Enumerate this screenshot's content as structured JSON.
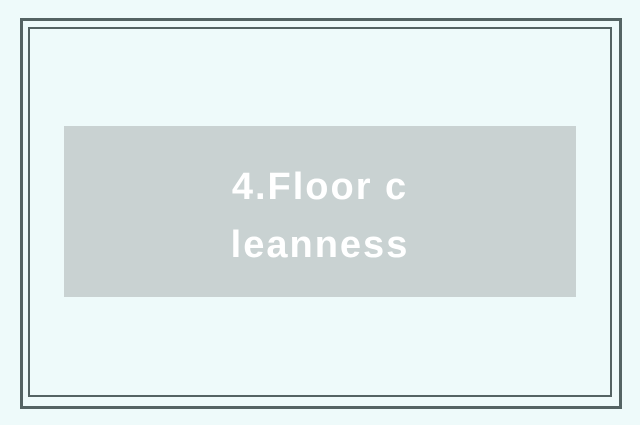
{
  "slide": {
    "background_color": "#eefafa",
    "frame": {
      "border_color": "#546363"
    },
    "title_box": {
      "background_color": "#c9d2d2",
      "text_color": "#ffffff",
      "full_text": "4.Floor cleanness",
      "lines": {
        "0": "4.Floor c",
        "1": "leanness"
      }
    }
  }
}
